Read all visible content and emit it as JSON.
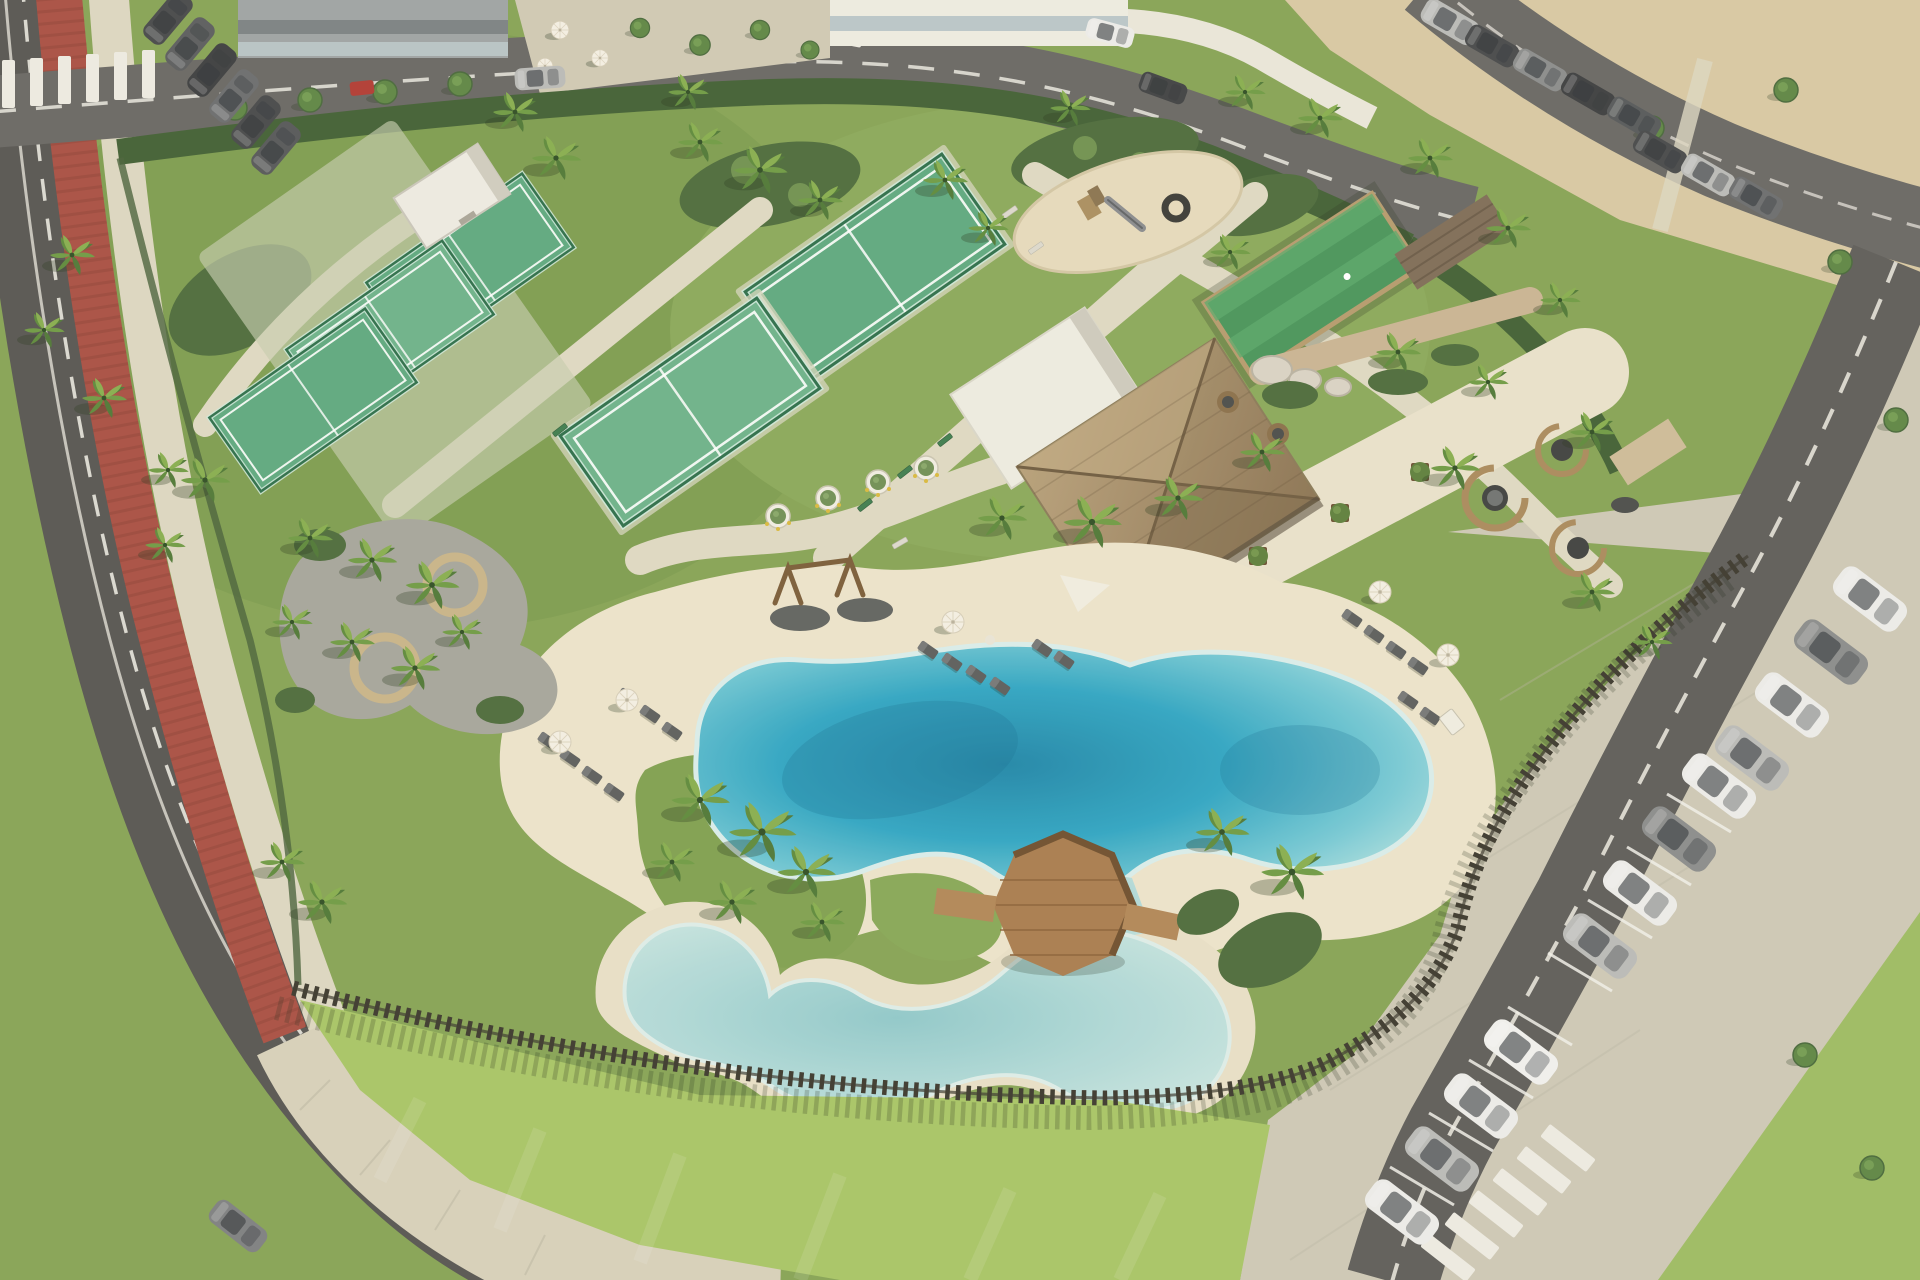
{
  "scene": {
    "title": "Aerial view of a beachfront resort amenity park",
    "setting": "daytime aerial 3D render: landscaped leisure park with lagoon pools between a curving road with red cycle lane, a sand beach and parking lots",
    "areas": [
      {
        "name": "padel-courts-west",
        "label": "three fenced padel courts"
      },
      {
        "name": "padel-courts-center",
        "label": "two glass-walled padel courts"
      },
      {
        "name": "courts-storage-building",
        "label": "small white storage building"
      },
      {
        "name": "playground",
        "label": "children's playground on sand oval with timber tower, slide and tire swing"
      },
      {
        "name": "turf-games-court",
        "label": "artificial turf court with timber surround"
      },
      {
        "name": "pavilion",
        "label": "thatched-roof pool bar pavilion with white flat-roof annex"
      },
      {
        "name": "pavilion-terrace",
        "label": "sand terrace with timber tree planters"
      },
      {
        "name": "stone-wall-feature",
        "label": "stone wall with boulders"
      },
      {
        "name": "lounge-pods",
        "label": "curved timber privacy pods with round daybeds"
      },
      {
        "name": "lagoon-pool",
        "label": "free-form turquoise lagoon pool with sandy beach deck"
      },
      {
        "name": "kids-pool",
        "label": "shallow free-form children's pool"
      },
      {
        "name": "water-channel",
        "label": "channel linking the two pools"
      },
      {
        "name": "timber-deck",
        "label": "octagonal timber deck bridge with railings over the channel"
      },
      {
        "name": "swing-frames",
        "label": "two timber swing frames on gravel pads"
      },
      {
        "name": "picnic-grove",
        "label": "gravel grove with circular timber benches around palms"
      },
      {
        "name": "sun-lounger-groups",
        "label": "grey sun loungers with white parasols in three groups"
      },
      {
        "name": "perimeter-fence",
        "label": "dark timber palisade fence"
      },
      {
        "name": "bike-lane",
        "label": "red cycle lane along curving west road"
      },
      {
        "name": "beach",
        "label": "sand beach at top right"
      },
      {
        "name": "parking-east",
        "label": "angled parking rows of white and silver cars"
      },
      {
        "name": "parking-north",
        "label": "street parking with dark cars"
      },
      {
        "name": "buildings-north",
        "label": "two flat buildings and a tree-lined plaza"
      }
    ],
    "counts": {
      "palm_trees": 40,
      "parked_cars_east": 12,
      "parked_cars_north": 7,
      "beach_road_cars": 8,
      "sun_loungers": 20,
      "umbrellas": 6,
      "lounge_pods": 3,
      "padel_courts": 5
    }
  },
  "colors": {
    "grass": "#85a355",
    "grass_dark": "#6d8c47",
    "lawn_bright": "#a7c566",
    "hedge": "#415f34",
    "shrub": "#4c6b3c",
    "sand_beach": "#d7c8a3",
    "deck_sand": "#ebe3cb",
    "kids_ring_sand": "#e7dfc7",
    "path": "#ded8c2",
    "sidewalk": "#d6d0ba",
    "plaza": "#cfc9b4",
    "road": "#565552",
    "road_light": "#686764",
    "asphalt_lot": "#5d5c59",
    "lot_pavers": "#cdc8b6",
    "road_line": "#e9e7df",
    "bike_lane": "#a84f43",
    "bike_lane_dark": "#8c4038",
    "pool_deep": "#1f86a8",
    "pool_mid": "#2fa5c3",
    "pool_light": "#74c8d4",
    "pool_rim": "#b2e0e0",
    "kids_deep": "#8fc8ca",
    "kids_light": "#c6e4e0",
    "court_green": "#5da87f",
    "court_frame": "#2d6e4a",
    "court_glass": "#cfe9dc",
    "turf_green": "#48945a",
    "thatch_light": "#b7a07a",
    "thatch_dark": "#8a7353",
    "white_roof": "#edebe1",
    "wood_deck": "#a87c4e",
    "wood_rail": "#6e4f2e",
    "boardwalk": "#b08657",
    "fence": "#3b382e",
    "gravel": "#a5a59b",
    "stone_wall": "#c9b493",
    "playground_sand": "#e5dabc",
    "car_white": "#ebebe9",
    "car_silver": "#b9bab8",
    "car_gray": "#8a8c8c",
    "car_dark": "#46484a",
    "truck_red": "#b03a33",
    "umbrella": "#f3efe3",
    "lounger": "#5b5d5c"
  }
}
